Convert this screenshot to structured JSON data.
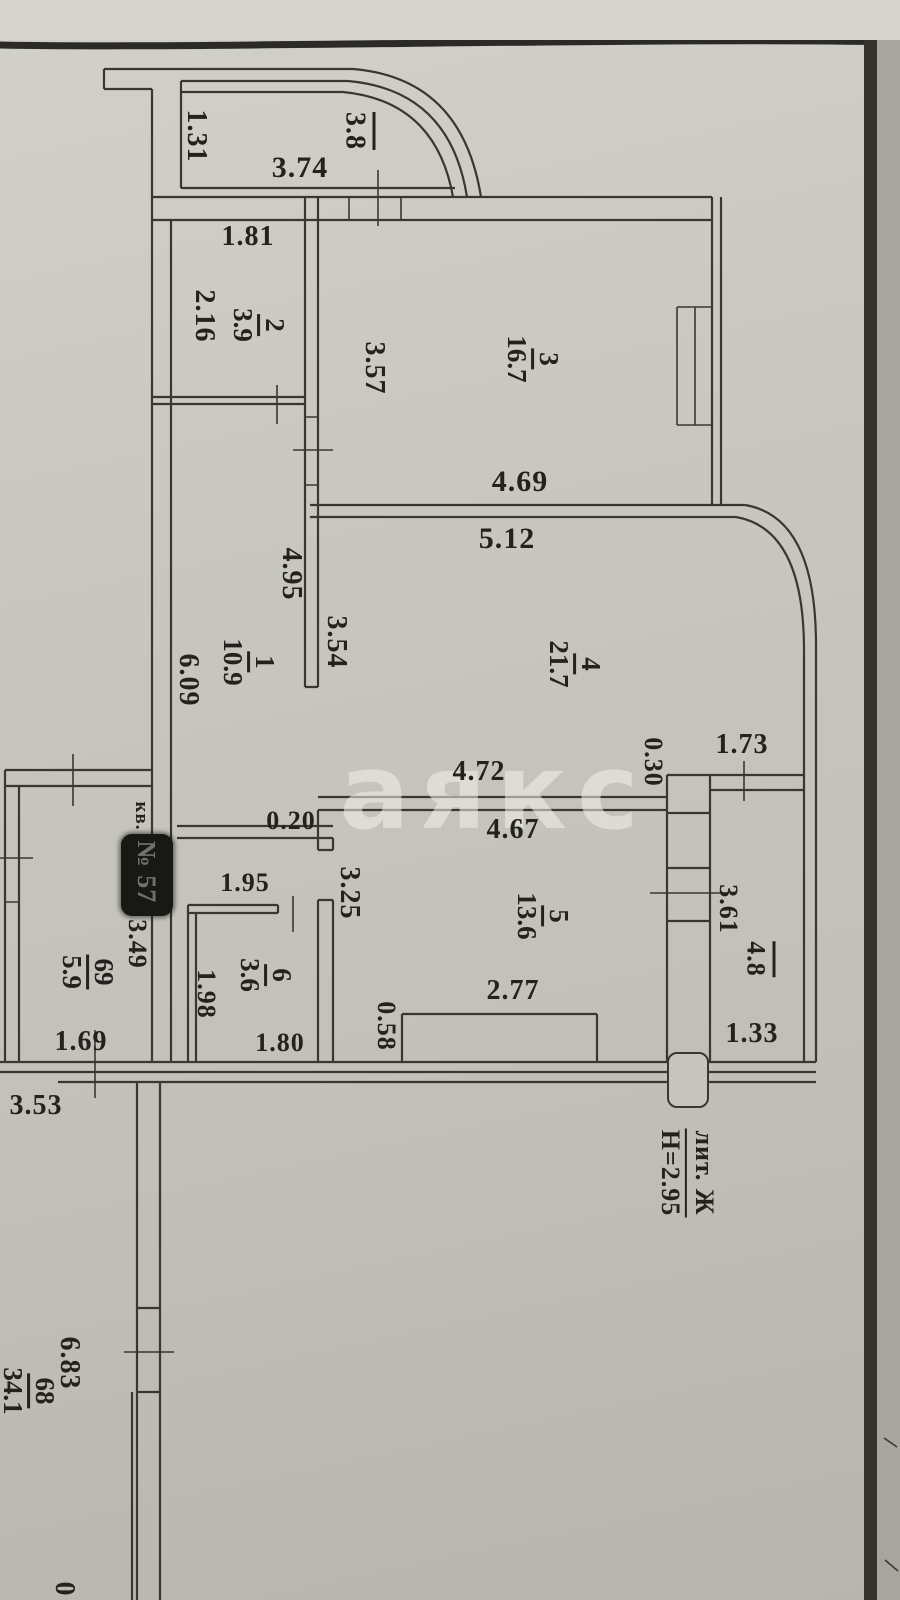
{
  "watermark": "аякс",
  "page": {
    "corner_digit": "0"
  },
  "apartment": {
    "prefix": "кв.",
    "number": "№ 57",
    "liter": "лит. Ж",
    "ceiling_height": "Н=2.95",
    "outside_dim": "3.53"
  },
  "rooms": {
    "r1": {
      "num": "1",
      "area": "10.9",
      "dim_right": "4.95",
      "dim_left": "6.09",
      "dim_passage": "0.20"
    },
    "r2": {
      "num": "2",
      "area": "3.9",
      "dim_top": "1.81",
      "dim_left": "2.16"
    },
    "r3": {
      "num": "3",
      "area": "16.7",
      "dim_left": "3.57",
      "dim_bottom": "4.69"
    },
    "r4": {
      "num": "4",
      "area": "21.7",
      "dim_top": "5.12",
      "dim_left": "3.54",
      "dim_bottom": "4.72",
      "dim_wall": "0.30",
      "dim_window": "1.73"
    },
    "r5": {
      "num": "5",
      "area": "13.6",
      "dim_top": "4.67",
      "dim_left": "3.25",
      "dim_closet": "2.77",
      "dim_closet_side": "0.58"
    },
    "r6": {
      "num": "6",
      "area": "3.6",
      "dim_top": "1.95",
      "dim_left": "1.98",
      "dim_bottom": "1.80"
    },
    "r69": {
      "num": "69",
      "area": "5.9",
      "dim_right": "3.49",
      "dim_bottom": "1.69"
    },
    "r68": {
      "num": "68",
      "area": "34.1",
      "dim_side": "6.83"
    },
    "balcony_top": {
      "area": "3.8",
      "dim_width": "3.74",
      "dim_depth": "1.31"
    },
    "balcony_right": {
      "area": "4.8",
      "dim_left": "3.61",
      "dim_bottom": "1.33"
    }
  }
}
